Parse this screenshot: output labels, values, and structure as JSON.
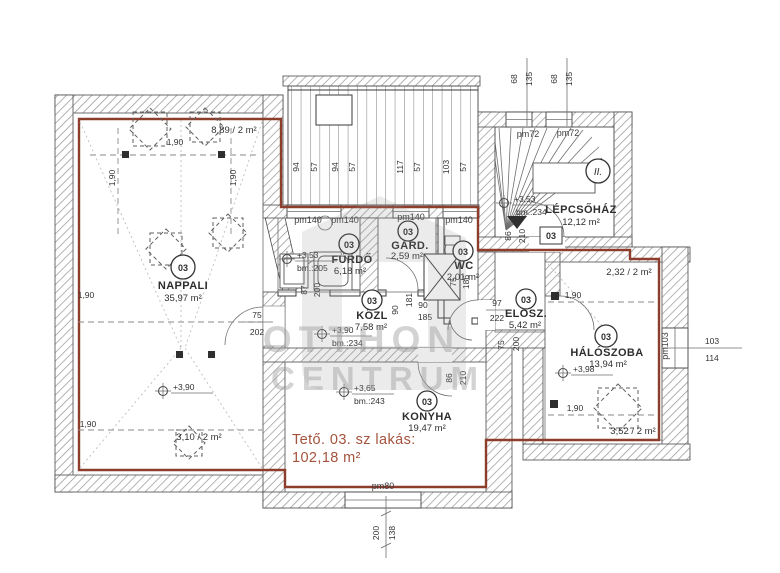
{
  "plan": {
    "title": {
      "line1": "Tető. 03. sz lakás:",
      "line2": "102,18 m²"
    },
    "watermark": {
      "line1": "OTTHON",
      "line2": "CENTRUM"
    },
    "colors": {
      "boundary": "#8e3c2c",
      "title_text": "#a4533c"
    },
    "rooms": {
      "nappali": {
        "num": "03",
        "name": "NAPPALI",
        "area": "35,97 m²"
      },
      "furdo": {
        "num": "03",
        "name": "FÜRDŐ",
        "area": "6,18 m²"
      },
      "gard": {
        "num": "03",
        "name": "GARD.",
        "area": "2,59 m²"
      },
      "wc": {
        "num": "03",
        "name": "WC",
        "area": "2,01 m²"
      },
      "kozl": {
        "num": "03",
        "name": "KÖZL",
        "area": "7,58 m²"
      },
      "elosz": {
        "num": "03",
        "name": "ELOSZ.",
        "area": "5,42 m²"
      },
      "haloszoba": {
        "num": "03",
        "name": "HÁLÓSZOBA",
        "area": "13,94 m²"
      },
      "konyha": {
        "num": "03",
        "name": "KONYHA",
        "area": "19,47 m²"
      },
      "lepcsohaz": {
        "name": "LÉPCSŐHÁZ",
        "area": "12,12 m²"
      }
    },
    "levels": {
      "furdo": {
        "value": "+3,53",
        "bm": "bm.:205"
      },
      "kozl": {
        "value": "+3,90",
        "bm": "bm.:234"
      },
      "konyha": {
        "value": "+3,65",
        "bm": "bm.:243"
      },
      "nappali": {
        "value": "+3,90"
      },
      "haloszoba": {
        "value": "+3,98"
      },
      "lepcsohaz": {
        "value": "+3,53",
        "bm": "bm.:234"
      }
    },
    "area_notes": {
      "nappali_top": "8,89 / 2 m²",
      "nappali_bottom": "3,10 / 2 m²",
      "haloszoba_top": "2,32 / 2 m²",
      "haloszoba_bottom": "3,52 / 2 m²"
    },
    "openings": {
      "pm140_a": "pm140",
      "pm140_b": "pm140",
      "pm140_c": "pm140",
      "pm140_d": "pm140",
      "pm72_a": "pm72",
      "pm72_b": "pm72",
      "pm103": "pm103",
      "pm80": "pm80"
    },
    "entrance_tag": "03",
    "level_icon": "II.",
    "dims": {
      "terrace": [
        "94",
        "57",
        "94",
        "57",
        "117",
        "57",
        "103",
        "57"
      ],
      "stair_top": [
        "68",
        "135",
        "68",
        "135"
      ],
      "entrance": [
        "86",
        "210"
      ],
      "kozl_left": [
        "87",
        "200"
      ],
      "wc": [
        "75",
        "186"
      ],
      "mid": [
        "181",
        "90",
        "90",
        "185"
      ],
      "elosz_frac": [
        "97",
        "222"
      ],
      "elosz_door": [
        "75",
        "200"
      ],
      "kitchen_door": [
        "86",
        "210"
      ],
      "nappali_pass": [
        "75",
        "202"
      ],
      "side_window": [
        "103",
        "114"
      ],
      "bottom": [
        "200",
        "138"
      ],
      "grid": "1,90"
    }
  }
}
